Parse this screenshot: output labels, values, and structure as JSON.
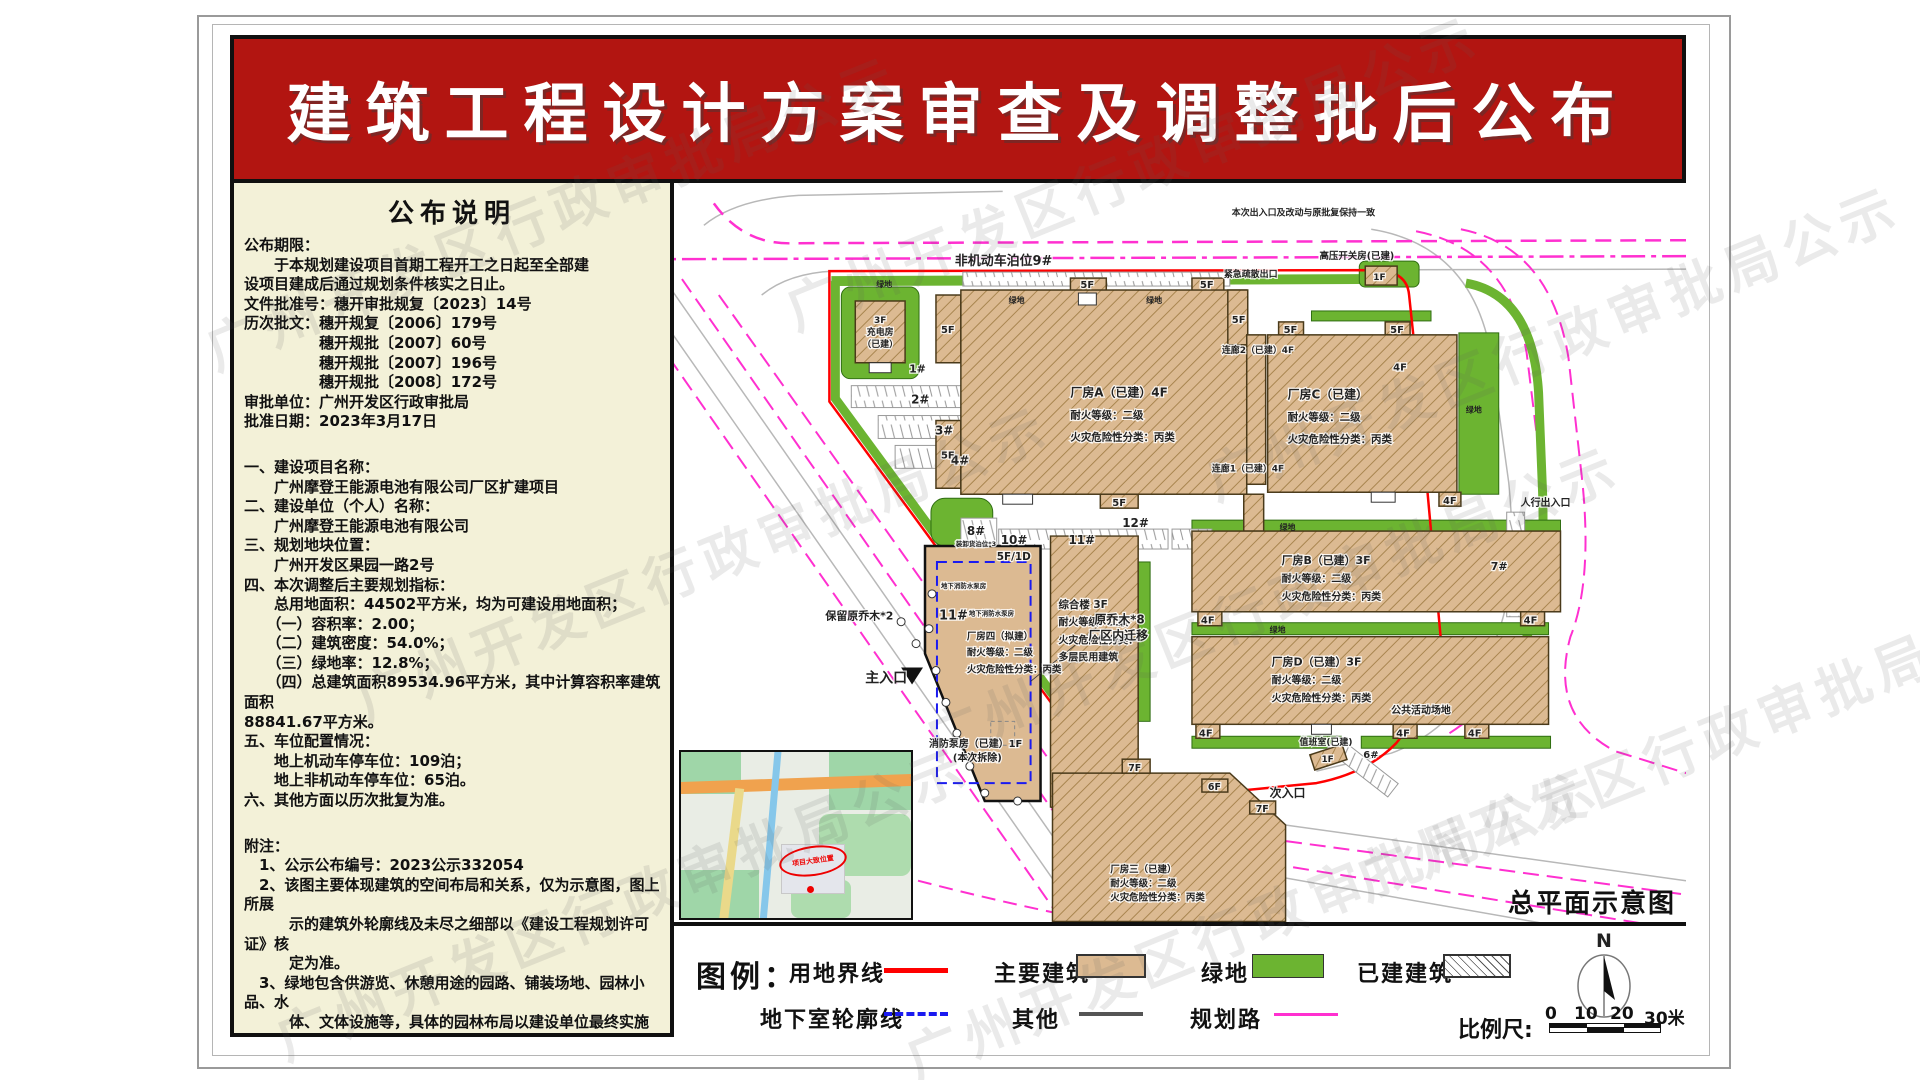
{
  "title": "建筑工程设计方案审查及调整批后公布",
  "watermark": "广州开发区行政审批局公示",
  "notes": {
    "heading": "公布说明",
    "lines": [
      "公布期限：",
      "　　于本规划建设项目首期工程开工之日起至全部建",
      "设项目建成后通过规划条件核实之日止。",
      "文件批准号：穗开审批规复〔2023〕14号",
      "历次批文：穗开规复〔2006〕179号",
      "　　　　　穗开规批〔2007〕60号",
      "　　　　　穗开规批〔2007〕196号",
      "　　　　　穗开规批〔2008〕172号",
      "审批单位：广州开发区行政审批局",
      "批准日期：2023年3月17日",
      "",
      "",
      "一、建设项目名称：",
      "　　广州摩登王能源电池有限公司厂区扩建项目",
      "二、建设单位（个人）名称：",
      "　　广州摩登王能源电池有限公司",
      "三、规划地块位置：",
      "　　广州开发区果园一路2号",
      "四、本次调整后主要规划指标：",
      "　　总用地面积：44502平方米，均为可建设用地面积；",
      "　　（一）容积率：2.00；",
      "　　（二）建筑密度：54.0%；",
      "　　（三）绿地率：12.8%；",
      "　　（四）总建筑面积89534.96平方米，其中计算容积率建筑面积",
      "88841.67平方米。",
      "五、车位配置情况：",
      "　　地上机动车停车位：109泊；",
      "　　地上非机动车停车位：65泊。",
      "六、其他方面以历次批复为准。",
      "",
      "",
      "附注：",
      "　1、公示公布编号：2023公示332054",
      "　2、该图主要体现建筑的空间布局和关系，仅为示意图，图上所展",
      "　　　示的建筑外轮廓线及未尽之细部以《建设工程规划许可证》核",
      "　　　定为准。",
      "　3、绿地包含供游览、休憩用途的园路、铺装场地、园林小品、水",
      "　　　体、文体设施等，具体的园林布局以建设单位最终实施的效果",
      "　　　为准。",
      "　4、建设单位联系电话：13560329109",
      "　5、查询网址：http://www.hp.gov.cn/zwgk/gsgb/index.html"
    ]
  },
  "map": {
    "caption": "总平面示意图",
    "inset_label": "项目大致位置",
    "labels": {
      "nonmotor": "非机动车泊位9#",
      "notice": "本次出入口及改动与原批复保持一致",
      "emergency": "紧急疏散出口",
      "gaoya": "高压开关房(已建)",
      "charge1": "3F",
      "charge2": "充电房",
      "charge3": "（已建）",
      "p1": "1#",
      "p2": "2#",
      "p3": "3#",
      "p4": "4#",
      "p6": "6#",
      "p7": "7#",
      "p8": "8#",
      "p10": "10#",
      "p11": "11#",
      "p12": "12#",
      "loading": "装卸货泊位*3",
      "a1": "厂房A（已建）4F",
      "b1": "厂房B（已建）3F",
      "c1": "厂房C（已建）",
      "d1": "厂房D（已建）3F",
      "e1": "厂房三（已建）",
      "fire": "耐火等级：二级",
      "hazard": "火灾危险性分类：丙类",
      "four_f": "5F/1D",
      "four_num": "11#",
      "four_name": "厂房四（拟建）",
      "zh1": "综合楼 3F",
      "zh3": "火灾危险性分类：",
      "zh4": "多层民用建筑",
      "cor1": "连廊1（已建）4F",
      "cor2": "连廊2（已建）4F",
      "pump": "地下消防水泵房",
      "trees8a": "原乔木*8",
      "trees8b": "厂区内迁移",
      "keep2": "保留原乔木*2",
      "fp1": "消防泵房（已建）1F",
      "fp2": "(本次拆除)",
      "main_entry": "主入口",
      "sub_entry": "次入口",
      "ped_entry": "人行出入口",
      "public_area": "公共活动场地",
      "duty": "值班室(已建)",
      "green": "绿地",
      "f5": "5F",
      "f4": "4F",
      "f7": "7F",
      "f6": "6F",
      "f1": "1F"
    }
  },
  "legend": {
    "heading": "图例：",
    "items": {
      "boundary": "用地界线",
      "main_building": "主要建筑",
      "green": "绿地",
      "built": "已建建筑",
      "basement": "地下室轮廓线",
      "other": "其他",
      "planned_road": "规划路"
    },
    "north": "N",
    "scale_label": "比例尺:",
    "scale_ticks": [
      "0",
      "10",
      "20",
      "30米"
    ]
  },
  "colors": {
    "banner_red": "#b21511",
    "boundary_red": "#ff0000",
    "building_tan": "#dcba92",
    "green": "#6cb431",
    "planned_road_magenta": "#ff30d0",
    "basement_blue": "#1a1af0"
  }
}
